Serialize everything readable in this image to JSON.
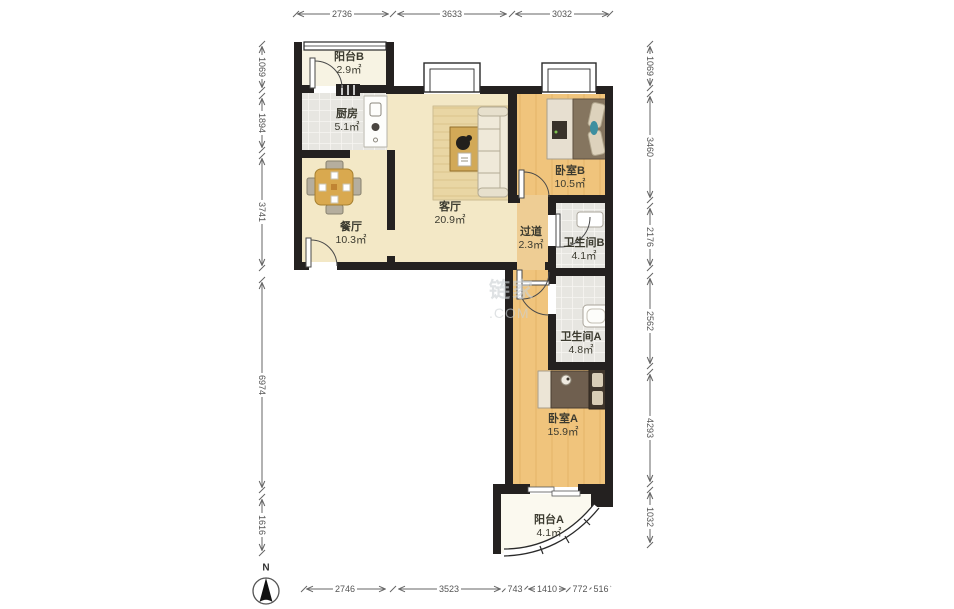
{
  "rooms": [
    {
      "id": "balcony-b",
      "name": "阳台B",
      "area": "2.9㎡"
    },
    {
      "id": "kitchen",
      "name": "厨房",
      "area": "5.1㎡"
    },
    {
      "id": "dining",
      "name": "餐厅",
      "area": "10.3㎡"
    },
    {
      "id": "living",
      "name": "客厅",
      "area": "20.9㎡"
    },
    {
      "id": "bedroom-b",
      "name": "卧室B",
      "area": "10.5㎡"
    },
    {
      "id": "hallway",
      "name": "过道",
      "area": "2.3㎡"
    },
    {
      "id": "bathroom-b",
      "name": "卫生间B",
      "area": "4.1㎡"
    },
    {
      "id": "bathroom-a",
      "name": "卫生间A",
      "area": "4.8㎡"
    },
    {
      "id": "bedroom-a",
      "name": "卧室A",
      "area": "15.9㎡"
    },
    {
      "id": "balcony-a",
      "name": "阳台A",
      "area": "4.1㎡"
    }
  ],
  "dimensions": {
    "top": [
      "2736",
      "3633",
      "3032"
    ],
    "left": [
      "1069",
      "1894",
      "3741",
      "6974",
      "1616"
    ],
    "right": [
      "1069",
      "3460",
      "2176",
      "2562",
      "4293",
      "1032"
    ],
    "bottom": [
      "2746",
      "3523",
      "743",
      "1410",
      "772",
      "516"
    ]
  },
  "compass": {
    "label": "N"
  },
  "watermark": {
    "line1": "链家",
    "line2": ".COM"
  },
  "colors": {
    "wall": "#242120",
    "floor_cream": "#f3e8c6",
    "floor_wood": "#f0c47c",
    "tile": "#e7e6e1"
  }
}
